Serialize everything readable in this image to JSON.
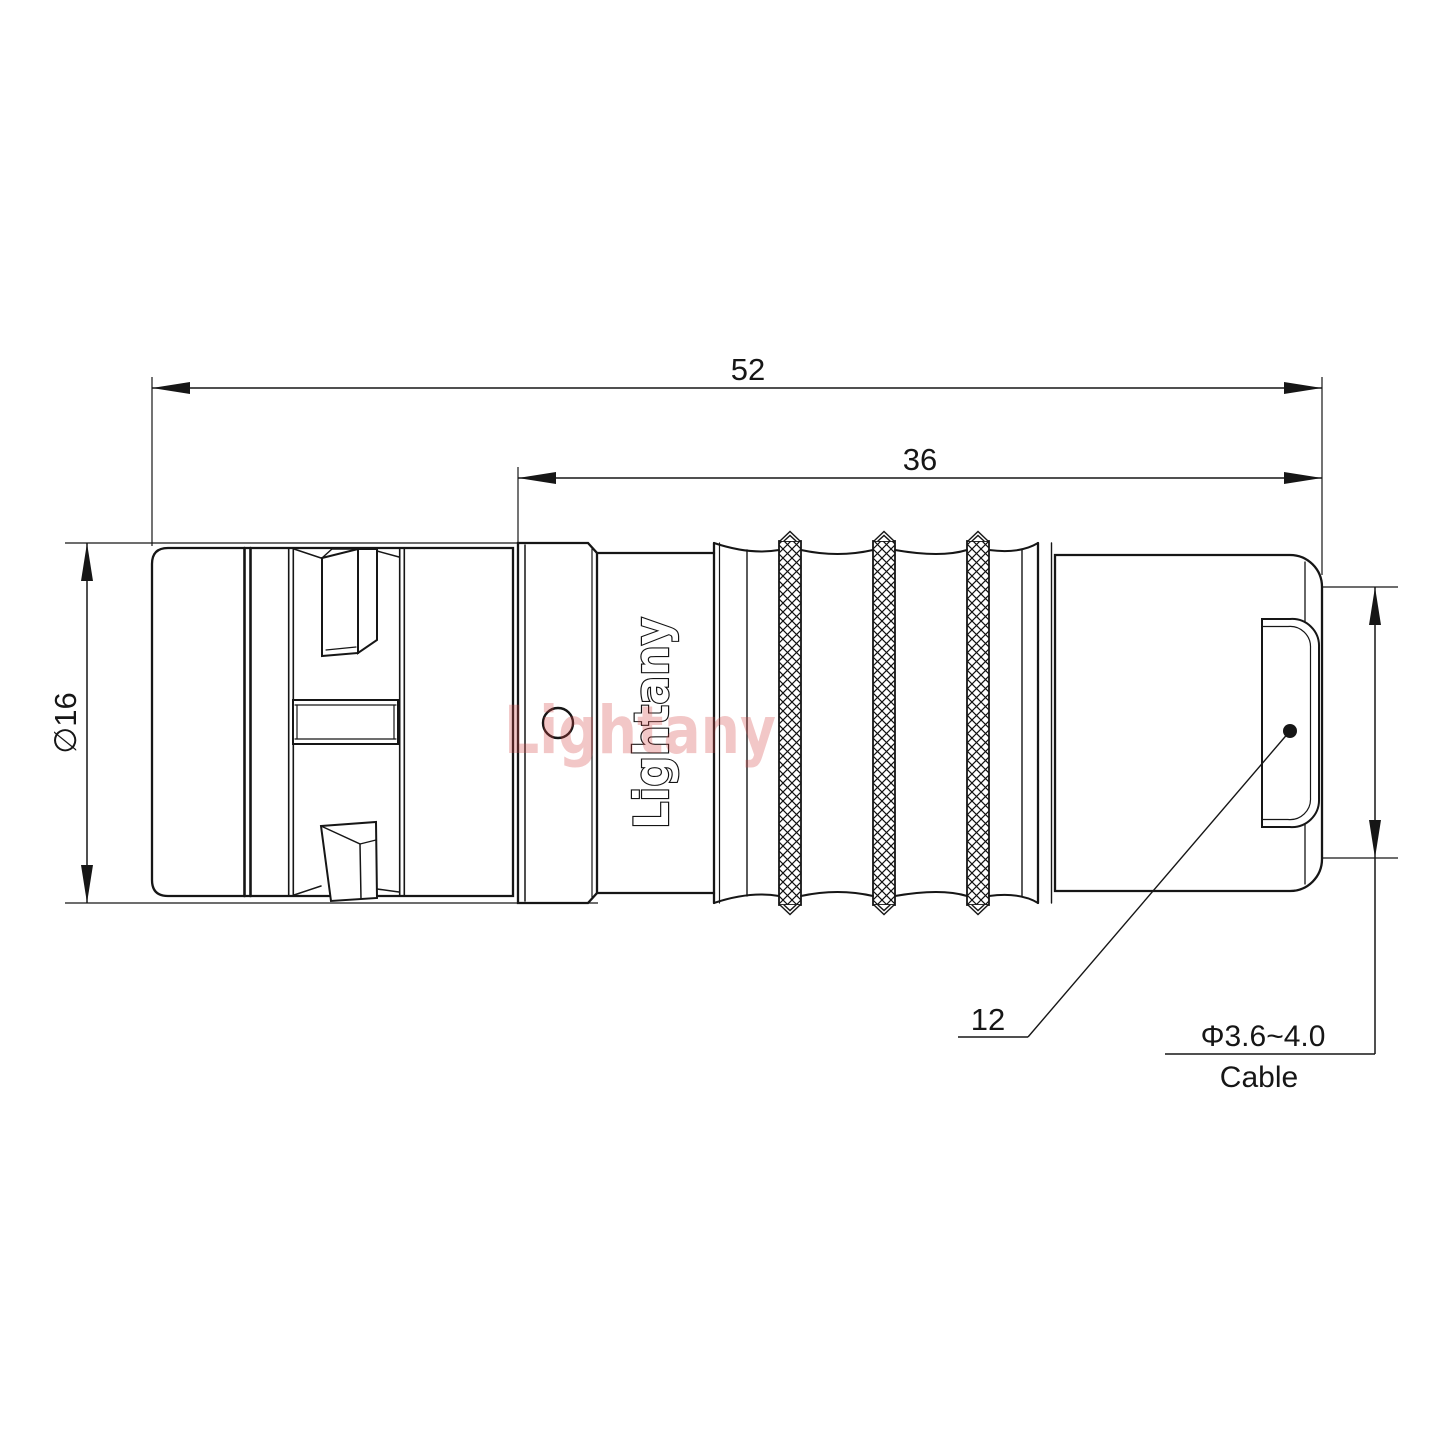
{
  "drawing": {
    "dimensions": {
      "overall_length": "52",
      "rear_section_length": "36",
      "body_diameter": "∅16",
      "connector_size": "12",
      "cable_diameter_range": "Φ3.6~4.0",
      "cable_word": "Cable"
    },
    "branding": {
      "logo_text": "Lightany",
      "watermark_text": "Lightany"
    },
    "colors": {
      "line_color": "#161616",
      "watermark_color": "rgba(211,69,69,0.30)",
      "background": "#ffffff"
    }
  }
}
